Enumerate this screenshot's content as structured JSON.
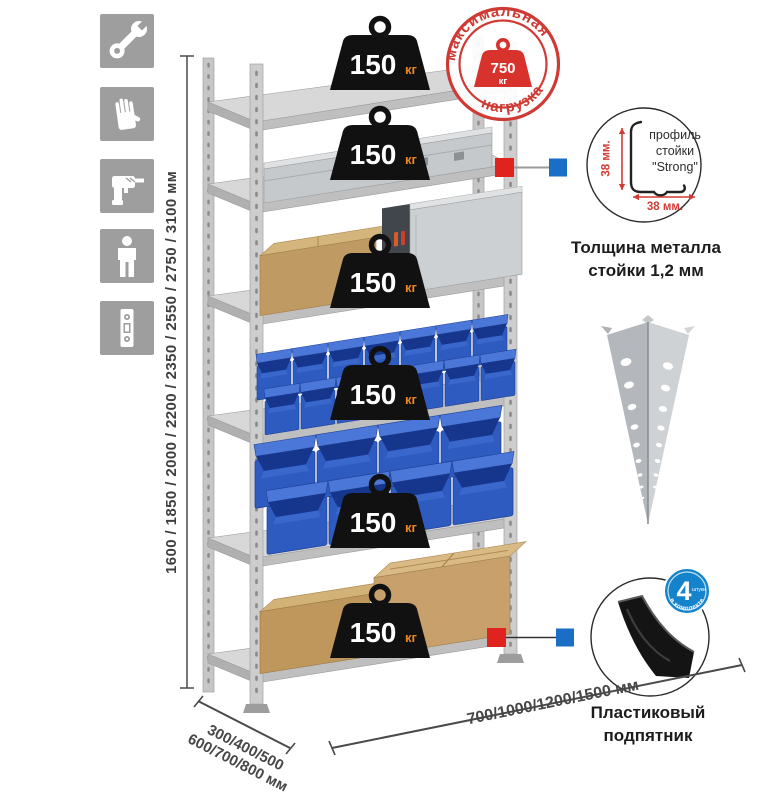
{
  "meta": {
    "title": "Стеллаж металлический — продуктовая схема"
  },
  "icons": {
    "tile_color": "#9e9e9e",
    "items": [
      {
        "name": "wrench-icon"
      },
      {
        "name": "gloves-icon"
      },
      {
        "name": "drill-icon"
      },
      {
        "name": "person-icon"
      },
      {
        "name": "level-icon"
      }
    ]
  },
  "dimensions": {
    "height_label": "1600 / 1850 / 2000 / 2200 / 2350 / 2550 / 2750 / 3100 мм",
    "depth_label_line1": "300/400/500",
    "depth_label_line2": "600/700/800 мм",
    "width_label": "700/1000/1200/1500 мм"
  },
  "rack": {
    "shelf_count": 6,
    "shelves": [
      {
        "load_value": "150",
        "load_unit": "кг",
        "contents": "empty"
      },
      {
        "load_value": "150",
        "load_unit": "кг",
        "contents": "aluminum-case"
      },
      {
        "load_value": "150",
        "load_unit": "кг",
        "contents": "cardboard-box-and-metal-case"
      },
      {
        "load_value": "150",
        "load_unit": "кг",
        "contents": "small-blue-bins"
      },
      {
        "load_value": "150",
        "load_unit": "кг",
        "contents": "large-blue-bins"
      },
      {
        "load_value": "150",
        "load_unit": "кг",
        "contents": "cardboard-boxes"
      }
    ]
  },
  "stamp": {
    "arc_top": "максимальная",
    "arc_bottom": "нагрузка",
    "weight_value": "750",
    "weight_unit": "кг",
    "color": "#cf3a34"
  },
  "profile_detail": {
    "line1": "профиль",
    "line2": "стойки",
    "line3": "\"Strong\"",
    "dim_vertical": "38 мм.",
    "dim_horizontal": "38 мм.",
    "caption_line1": "Толщина металла",
    "caption_line2": "стойки 1,2 мм"
  },
  "foot_detail": {
    "badge_value": "4",
    "badge_small": "штуки",
    "badge_arc": "в комплекте",
    "badge_color": "#1583cc",
    "caption_line1": "Пластиковый",
    "caption_line2": "подпятник"
  },
  "colors": {
    "badge_black": "#111111",
    "badge_unit_orange": "#e8872b",
    "marker_red": "#e0231e",
    "marker_blue": "#1b6ec6",
    "bin_blue": "#2d5bbf",
    "steel_gray": "#c9c9c9",
    "cardboard": "#c7a06b"
  }
}
